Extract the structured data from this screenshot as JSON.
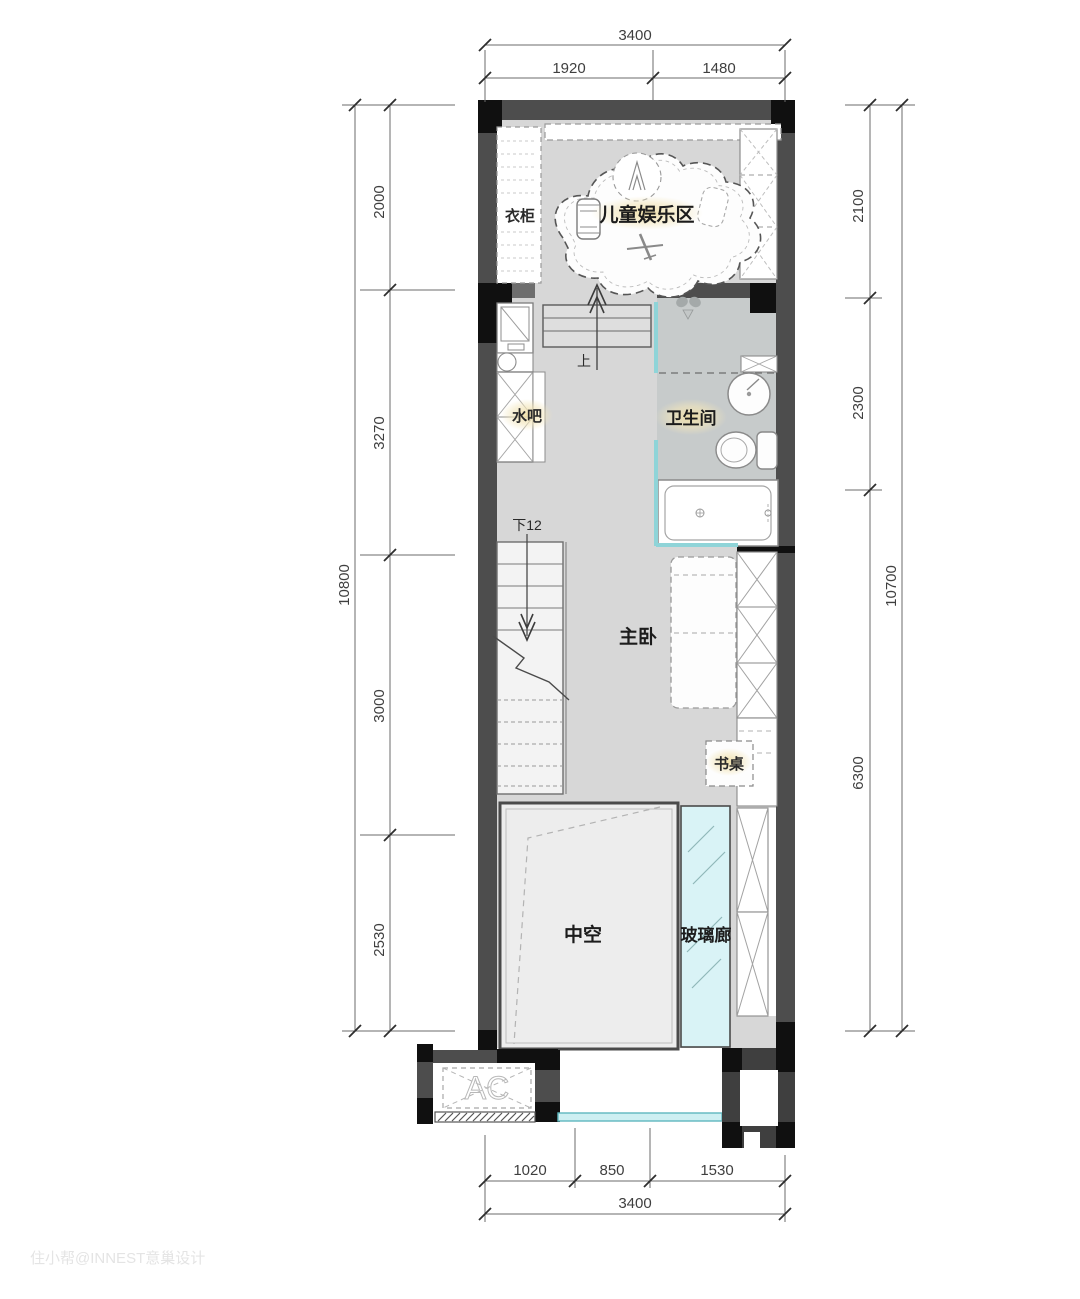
{
  "labels": {
    "wardrobe": "衣柜",
    "kids_play_area": "儿童娱乐区",
    "water_bar": "水吧",
    "bathroom": "卫生间",
    "master_bedroom": "主卧",
    "desk": "书桌",
    "void": "中空",
    "glass_corridor": "玻璃廊",
    "ac_unit": "AC",
    "stair_up": "上",
    "stair_down": "下12"
  },
  "dimensions": {
    "top": {
      "overall": "3400",
      "segments": [
        "1920",
        "1480"
      ]
    },
    "bottom": {
      "overall": "3400",
      "segments": [
        "1020",
        "850",
        "1530"
      ]
    },
    "left": {
      "overall": "10800",
      "segments": [
        "2000",
        "3270",
        "3000",
        "2530"
      ]
    },
    "right": {
      "overall": "10700",
      "segments": [
        "2100",
        "2300",
        "6300"
      ]
    }
  },
  "watermark": "住小帮@INNEST意巢设计",
  "colors": {
    "wall_gray": "#4d4d4d",
    "wall_black": "#101010",
    "floor_main": "#d7d7d7",
    "floor_bathroom": "#c7cbcb",
    "floor_void": "#ededed",
    "glass_fill": "#d9f3f6",
    "glass_line": "#8fd4d8",
    "label_glow": "#f0dfa6",
    "dimension_text": "#3f3f3f"
  }
}
